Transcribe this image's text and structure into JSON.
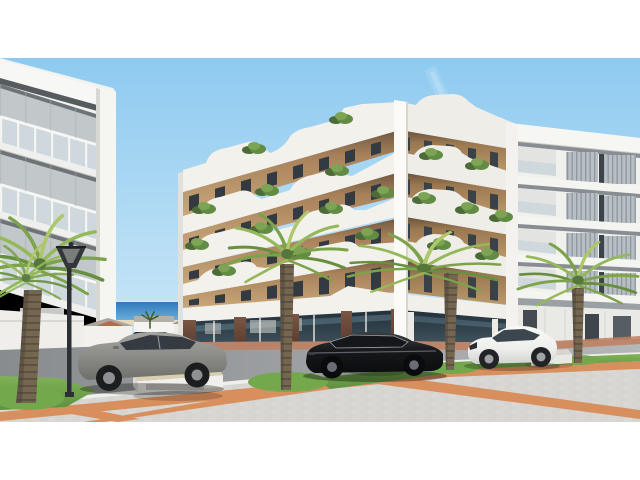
{
  "scene": {
    "type": "architectural-render-photo",
    "description": "New-build corner apartment building with wavy white balcony bands and wood facade, beside neighbouring white apartment blocks, palm trees, parked cars, benches, a street lamp, sea horizon with beach houses in the gap, and a paved promenade with orange diagonal bands",
    "objects": [
      {
        "id": "sky",
        "label": "clear blue sky"
      },
      {
        "id": "sea-horizon",
        "label": "sea horizon with beach strip"
      },
      {
        "id": "beach-houses",
        "label": "distant white beach houses"
      },
      {
        "id": "left-apartment-building",
        "label": "white balcony apartment block (left)"
      },
      {
        "id": "main-corner-building",
        "label": "corner building with wavy white balconies and wood walls"
      },
      {
        "id": "right-apartment-building",
        "label": "white apartment block with grey louvre panels (right)"
      },
      {
        "id": "street-road",
        "label": "asphalt street"
      },
      {
        "id": "sidewalk-pavement",
        "label": "grey block paving with orange diagonal bands"
      },
      {
        "id": "grass-verges",
        "label": "green grass verges"
      },
      {
        "id": "palm-trees",
        "label": "four palm trees"
      },
      {
        "id": "street-lamp",
        "label": "black street lamp"
      },
      {
        "id": "benches",
        "label": "three street benches"
      },
      {
        "id": "silver-sedan",
        "label": "grey parked sedan"
      },
      {
        "id": "dark-parked-car",
        "label": "dark car parked in background"
      },
      {
        "id": "black-luxury-sedan",
        "label": "black luxury sedan"
      },
      {
        "id": "white-suv-coupe",
        "label": "white SUV coupe"
      }
    ]
  },
  "colors": {
    "sky-top": "#8ecaf0",
    "sky-mid": "#badff5",
    "sky-low": "#dbeefa",
    "sea": "#2f7abc",
    "sea-light": "#6fb0da",
    "sand": "#e6d9bd",
    "white-band": "#f3f1ec",
    "band-shadow": "#c9c7c0",
    "wood": "#b98d5e",
    "window-dark": "#333a41",
    "brick": "#6a463a",
    "glass-store": "#2c3940",
    "glass-reflect": "#7fa3b5",
    "right-grey": "#b7bfc5",
    "balustrade": "#ced8dd",
    "road": "#97999b",
    "kerb": "#f0efe9",
    "pavement": "#d7d6d2",
    "orange-band": "#d98852",
    "terracotta": "#bf7f5e",
    "grass": "#74a84c",
    "palm-green": "#7ca24a",
    "palm-light": "#aec768",
    "trunk": "#74664f",
    "lamp": "#2c2f33",
    "car-grey": "#8b8b88",
    "car-black": "#141518",
    "car-white": "#f3f3f1",
    "bench-top": "#d9cfae",
    "white-struct": "#f2f2ef"
  }
}
